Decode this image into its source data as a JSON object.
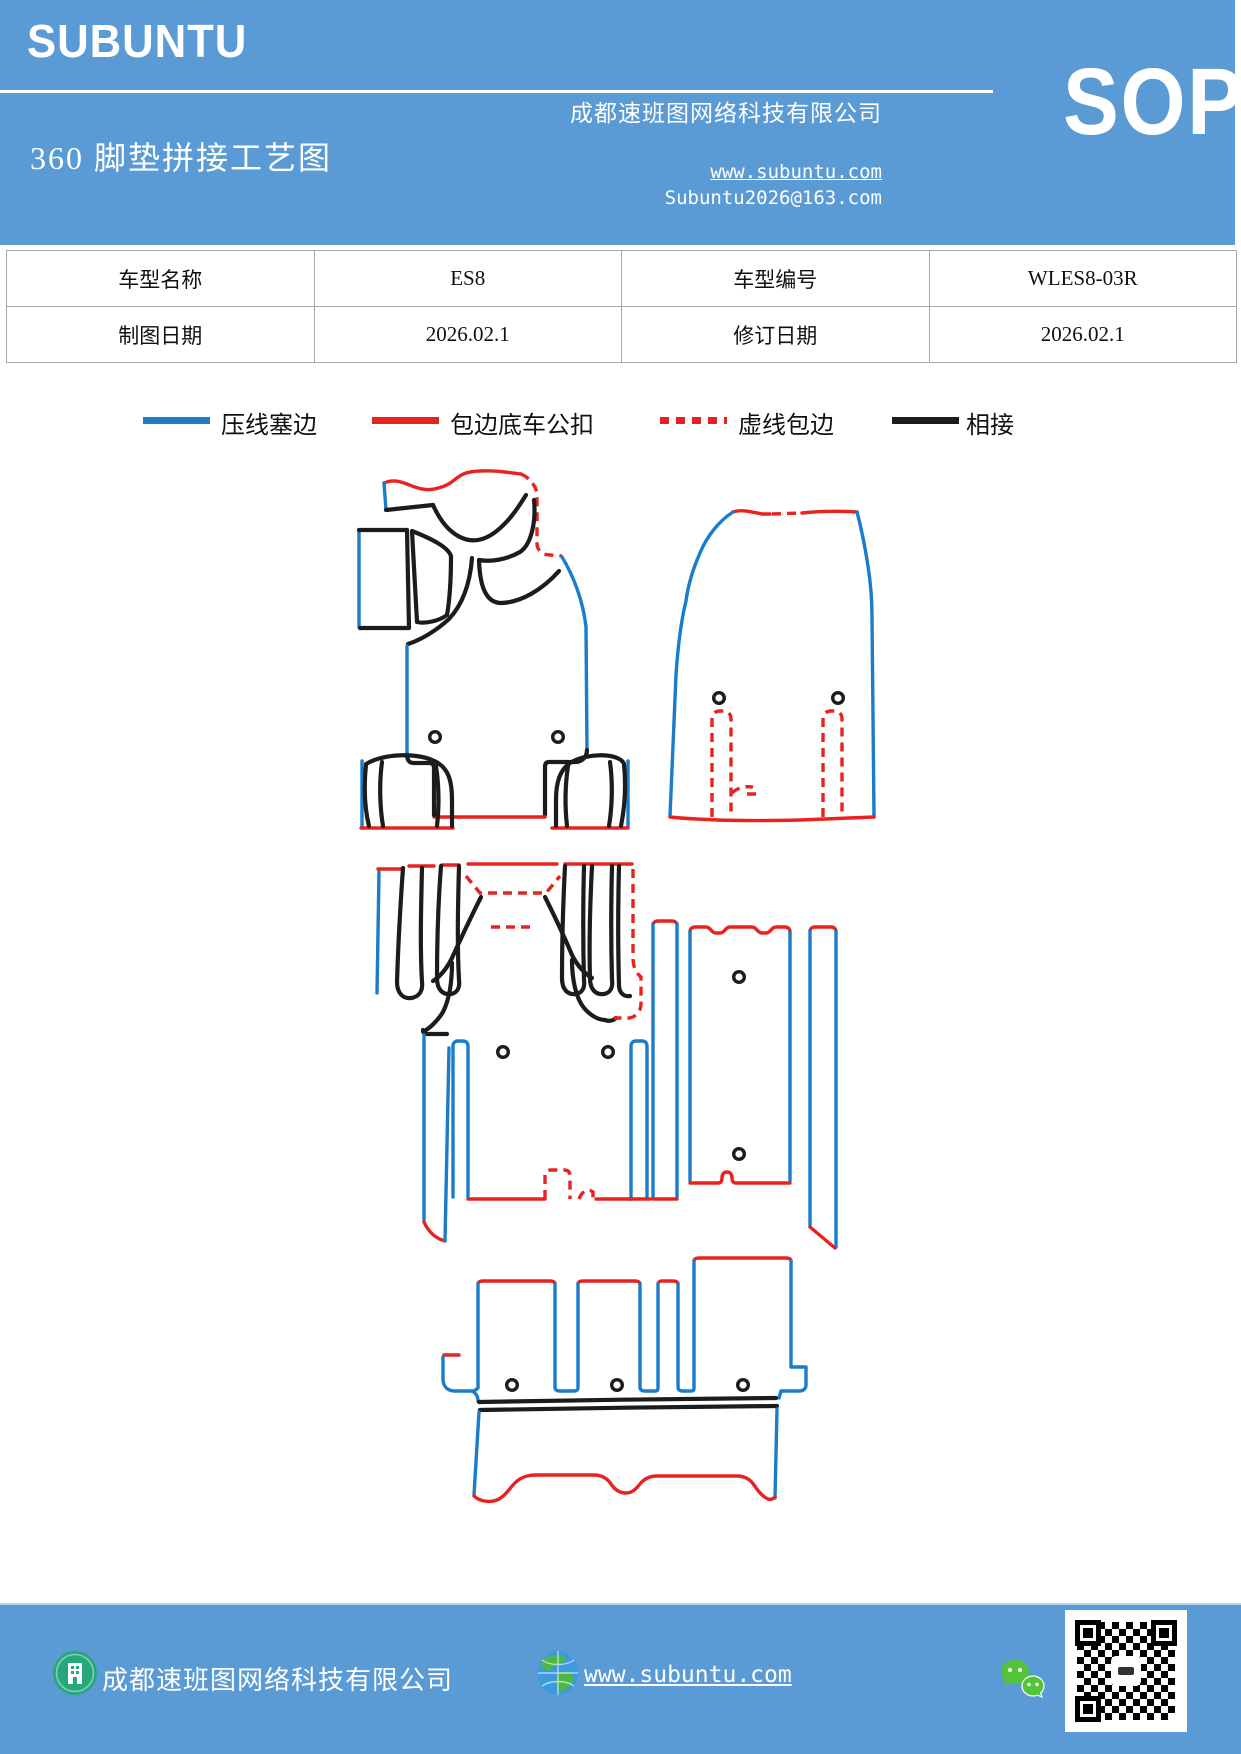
{
  "colors": {
    "page_bg": "#ffffff",
    "brand_blue": "#5b9bd5",
    "line_blue": "#1b7cc9",
    "line_red": "#e8231f",
    "line_black": "#1c1c1c",
    "table_border": "#a9a9a9",
    "footer_green": "#27a77c",
    "wechat_green": "#55c337",
    "globe_blue": "#3d9ae0",
    "globe_green": "#4db848"
  },
  "header": {
    "logo": "SUBUNTU",
    "title": "360 脚垫拼接工艺图",
    "company": "成都速班图网络科技有限公司",
    "website": "www.subuntu.com",
    "email": "Subuntu2026@163.com",
    "badge": "SOP"
  },
  "info_table": {
    "rows": [
      {
        "cells": [
          "车型名称",
          "ES8",
          "车型编号",
          "WLES8-03R"
        ]
      },
      {
        "cells": [
          "制图日期",
          "2026.02.1",
          "修订日期",
          "2026.02.1"
        ]
      }
    ]
  },
  "legend": {
    "items": [
      {
        "label": "压线塞边",
        "color": "#1b7cc9",
        "style": "solid"
      },
      {
        "label": "包边底车公扣",
        "color": "#e8231f",
        "style": "solid"
      },
      {
        "label": "虚线包边",
        "color": "#e8231f",
        "style": "dotted"
      },
      {
        "label": "相接",
        "color": "#1c1c1c",
        "style": "solid"
      }
    ]
  },
  "footer": {
    "company": "成都速班图网络科技有限公司",
    "website": "www.subuntu.com"
  }
}
